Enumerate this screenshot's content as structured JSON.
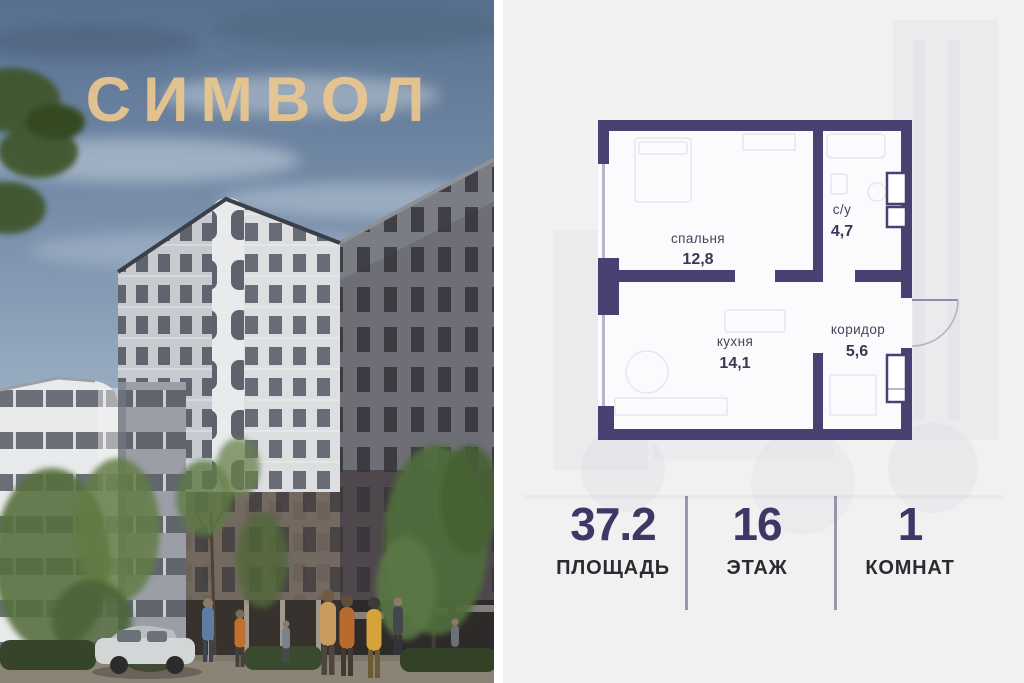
{
  "logo": {
    "text": "СИМВОЛ",
    "color": "#ebc78e"
  },
  "photo": {
    "description": "residential complex render",
    "sky_color": "#6d84a1",
    "accent_people_colors": [
      "#c2702f",
      "#d6a23c",
      "#5d7da0"
    ]
  },
  "floor_plan": {
    "wall_color": "#484273",
    "rooms": [
      {
        "name": "спальня",
        "area": "12,8"
      },
      {
        "name": "с/у",
        "area": "4,7"
      },
      {
        "name": "кухня",
        "area": "14,1"
      },
      {
        "name": "коридор",
        "area": "5,6"
      }
    ]
  },
  "stats": {
    "value_color": "#3c3966",
    "label_color": "#2c2b31",
    "items": [
      {
        "value": "37.2",
        "label": "ПЛОЩАДЬ"
      },
      {
        "value": "16",
        "label": "ЭТАЖ"
      },
      {
        "value": "1",
        "label": "КОМНАТ"
      }
    ]
  }
}
